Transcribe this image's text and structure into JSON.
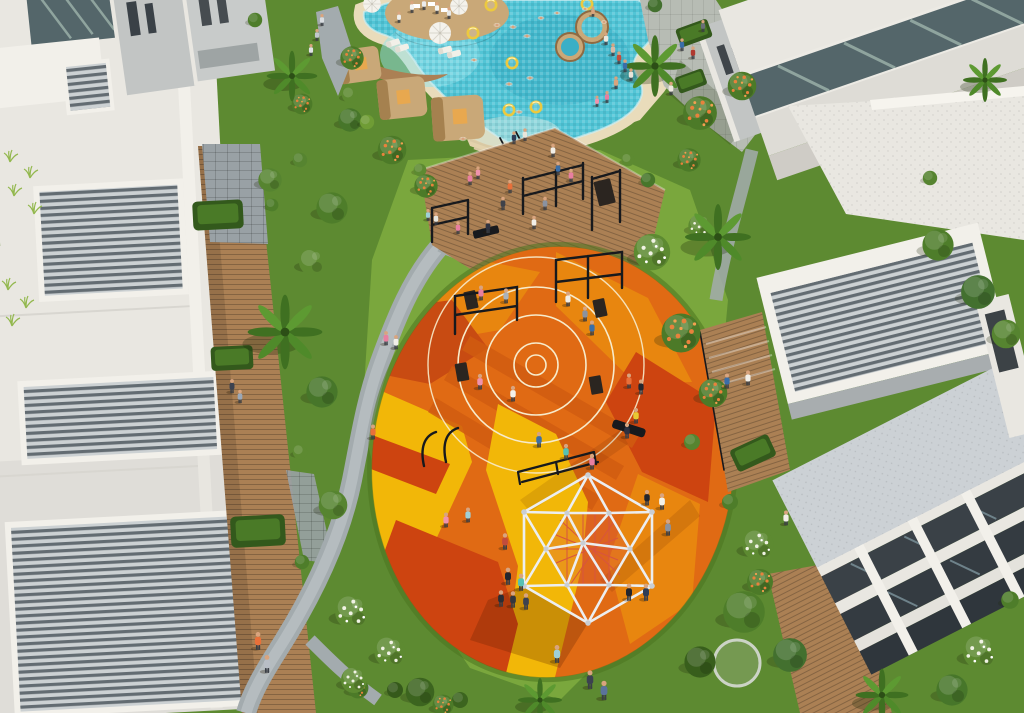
{
  "colors": {
    "poolWater": "#52c5d6",
    "poolDeep": "#3aafc6",
    "poolShallow": "#93e4ec",
    "sand": "#e9dcbb",
    "beach": "#e3d2ac",
    "woodDeck": "#ab8054",
    "woodCabana": "#c9a878",
    "cabanaDark": "#a5814f",
    "lawn": "#5d8a31",
    "lawnBright": "#7aa73d",
    "green": "#4e7d2a",
    "greenDark": "#35591b",
    "blossomOrange": "#e8823c",
    "blossomWhite": "#f0f2e4",
    "path": "#a3abae",
    "pathLight": "#c2c8ca",
    "paver": "#99a1a5",
    "promenade": "#b7bcb4",
    "white": "#f2f0ea",
    "offWhite": "#e9e7e1",
    "roofShade": "#d6d4ce",
    "grayWall": "#c2c5c4",
    "darkWall": "#3a4147",
    "louverLight": "#ccd1d3",
    "louverDark": "#636c72",
    "glass": "#54666a",
    "glassLight": "#8fa49e",
    "playOrange": "#e06a14",
    "playAmber": "#e8860f",
    "playYellow": "#f2b708",
    "playRed": "#cd4410",
    "playDeep": "#c84b12",
    "playDark": "#d05c10",
    "courtLine": "#f7ebcb",
    "equip": "#17191d",
    "board": "#2b2520",
    "domeStrut": "#eceef0",
    "domeNode": "#c9ced4",
    "domeNet": "#d8543e",
    "skin": "#d9a47e",
    "shadow": "rgba(60,30,8,0.3)"
  },
  "people": [
    {
      "x": 412,
      "y": 11,
      "c": "#f2f2ee",
      "s": 0.8
    },
    {
      "x": 424,
      "y": 8,
      "c": "#ececec",
      "s": 0.8
    },
    {
      "x": 437,
      "y": 12,
      "c": "#f4f4f0",
      "s": 0.8
    },
    {
      "x": 449,
      "y": 17,
      "c": "#e8e8e4",
      "s": 0.8
    },
    {
      "x": 399,
      "y": 21,
      "c": "#f0f0ec",
      "s": 0.75
    },
    {
      "x": 322,
      "y": 24,
      "c": "#d8dce0",
      "s": 0.8
    },
    {
      "x": 317,
      "y": 39,
      "c": "#c2c8ce",
      "s": 0.8
    },
    {
      "x": 311,
      "y": 54,
      "c": "#e0e2e6",
      "s": 0.8
    },
    {
      "x": 606,
      "y": 43,
      "c": "#ece8de",
      "s": 0.85
    },
    {
      "x": 613,
      "y": 54,
      "c": "#d9b9a6",
      "s": 0.85
    },
    {
      "x": 619,
      "y": 62,
      "c": "#c24c3c",
      "s": 0.85
    },
    {
      "x": 625,
      "y": 70,
      "c": "#3a6ea8",
      "s": 0.85
    },
    {
      "x": 631,
      "y": 79,
      "c": "#e8e4da",
      "s": 0.85
    },
    {
      "x": 616,
      "y": 87,
      "c": "#d9a47e",
      "s": 0.85
    },
    {
      "x": 607,
      "y": 101,
      "c": "#e87fa0",
      "s": 0.8
    },
    {
      "x": 597,
      "y": 105,
      "c": "#ef93ad",
      "s": 0.75
    },
    {
      "x": 682,
      "y": 49,
      "c": "#3a6ea8",
      "s": 0.85
    },
    {
      "x": 693,
      "y": 57,
      "c": "#b03a30",
      "s": 0.85
    },
    {
      "x": 671,
      "y": 93,
      "c": "#eceadf",
      "s": 0.9
    },
    {
      "x": 703,
      "y": 30,
      "c": "#6a7078",
      "s": 0.8
    },
    {
      "x": 514,
      "y": 142,
      "c": "#2e3d57",
      "s": 0.85
    },
    {
      "x": 525,
      "y": 139,
      "c": "#e8e6da",
      "s": 0.85
    },
    {
      "x": 593,
      "y": 15,
      "c": "#d9a47e",
      "s": 0.7
    },
    {
      "x": 470,
      "y": 183,
      "c": "#e87fa0",
      "s": 0.9
    },
    {
      "x": 478,
      "y": 177,
      "c": "#ef93ad",
      "s": 0.85
    },
    {
      "x": 510,
      "y": 191,
      "c": "#e8703a",
      "s": 0.9
    },
    {
      "x": 553,
      "y": 155,
      "c": "#f2efe8",
      "s": 0.9
    },
    {
      "x": 558,
      "y": 173,
      "c": "#3a6ea8",
      "s": 0.9
    },
    {
      "x": 571,
      "y": 180,
      "c": "#e87fa0",
      "s": 0.9
    },
    {
      "x": 503,
      "y": 208,
      "c": "#3e424a",
      "s": 0.9
    },
    {
      "x": 488,
      "y": 231,
      "c": "#2e3140",
      "s": 0.9
    },
    {
      "x": 436,
      "y": 223,
      "c": "#e8e6de",
      "s": 0.85
    },
    {
      "x": 428,
      "y": 219,
      "c": "#9fd0d8",
      "s": 0.8
    },
    {
      "x": 458,
      "y": 232,
      "c": "#e87fa0",
      "s": 0.85
    },
    {
      "x": 534,
      "y": 227,
      "c": "#f2efe8",
      "s": 0.9
    },
    {
      "x": 545,
      "y": 208,
      "c": "#8a92a0",
      "s": 0.9
    },
    {
      "x": 386,
      "y": 343,
      "c": "#e87fa0",
      "s": 0.95
    },
    {
      "x": 396,
      "y": 347,
      "c": "#f2efe8",
      "s": 0.95
    },
    {
      "x": 373,
      "y": 437,
      "c": "#e8703a",
      "s": 1
    },
    {
      "x": 232,
      "y": 391,
      "c": "#3c4250",
      "s": 0.95
    },
    {
      "x": 240,
      "y": 401,
      "c": "#9aa8b8",
      "s": 0.9
    },
    {
      "x": 258,
      "y": 647,
      "c": "#e8703a",
      "s": 1.2
    },
    {
      "x": 267,
      "y": 670,
      "c": "#b8bec6",
      "s": 1.2
    },
    {
      "x": 481,
      "y": 298,
      "c": "#e87fa0",
      "s": 1
    },
    {
      "x": 506,
      "y": 301,
      "c": "#aab2ba",
      "s": 1
    },
    {
      "x": 568,
      "y": 304,
      "c": "#f2efe8",
      "s": 1
    },
    {
      "x": 585,
      "y": 319,
      "c": "#8a92a0",
      "s": 1
    },
    {
      "x": 592,
      "y": 333,
      "c": "#3a6ea8",
      "s": 1
    },
    {
      "x": 480,
      "y": 387,
      "c": "#ef93ad",
      "s": 1.05
    },
    {
      "x": 513,
      "y": 399,
      "c": "#f4f2ea",
      "s": 1.05
    },
    {
      "x": 539,
      "y": 445,
      "c": "#3a6ea8",
      "s": 1.05
    },
    {
      "x": 566,
      "y": 457,
      "c": "#56c0b4",
      "s": 1.05
    },
    {
      "x": 592,
      "y": 467,
      "c": "#e87fa0",
      "s": 1.05
    },
    {
      "x": 627,
      "y": 436,
      "c": "#2e3140",
      "s": 1.05
    },
    {
      "x": 636,
      "y": 421,
      "c": "#e8c832",
      "s": 1.05
    },
    {
      "x": 629,
      "y": 386,
      "c": "#e8703a",
      "s": 1
    },
    {
      "x": 641,
      "y": 392,
      "c": "#23262e",
      "s": 1
    },
    {
      "x": 662,
      "y": 507,
      "c": "#f4f2ea",
      "s": 1.1
    },
    {
      "x": 668,
      "y": 533,
      "c": "#8a92a0",
      "s": 1.1
    },
    {
      "x": 647,
      "y": 503,
      "c": "#23262e",
      "s": 1.05
    },
    {
      "x": 446,
      "y": 525,
      "c": "#ef93ad",
      "s": 1
    },
    {
      "x": 468,
      "y": 520,
      "c": "#9fd0d8",
      "s": 1
    },
    {
      "x": 505,
      "y": 547,
      "c": "#c24c3c",
      "s": 1.1
    },
    {
      "x": 508,
      "y": 582,
      "c": "#23262e",
      "s": 1.15
    },
    {
      "x": 521,
      "y": 588,
      "c": "#56c0b4",
      "s": 1.15
    },
    {
      "x": 629,
      "y": 598,
      "c": "#23262e",
      "s": 1.15
    },
    {
      "x": 646,
      "y": 598,
      "c": "#2e3d57",
      "s": 1.15
    },
    {
      "x": 501,
      "y": 604,
      "c": "#2a2d34",
      "s": 1.1
    },
    {
      "x": 513,
      "y": 605,
      "c": "#33363e",
      "s": 1.1
    },
    {
      "x": 526,
      "y": 607,
      "c": "#3c4250",
      "s": 1.1
    },
    {
      "x": 557,
      "y": 660,
      "c": "#9fd0d8",
      "s": 1.2
    },
    {
      "x": 590,
      "y": 686,
      "c": "#3c4250",
      "s": 1.25
    },
    {
      "x": 604,
      "y": 697,
      "c": "#5b739c",
      "s": 1.3
    },
    {
      "x": 727,
      "y": 386,
      "c": "#3a6ea8",
      "s": 1
    },
    {
      "x": 748,
      "y": 383,
      "c": "#f2efe8",
      "s": 1
    },
    {
      "x": 786,
      "y": 523,
      "c": "#f2efe8",
      "s": 1
    }
  ],
  "swimmers": [
    {
      "x": 513,
      "y": 27,
      "s": 0.8
    },
    {
      "x": 497,
      "y": 25,
      "s": 0.75
    },
    {
      "x": 527,
      "y": 36,
      "s": 0.8
    },
    {
      "x": 541,
      "y": 18,
      "s": 0.75
    },
    {
      "x": 557,
      "y": 13,
      "s": 0.7
    },
    {
      "x": 585,
      "y": 9,
      "s": 0.7
    },
    {
      "x": 530,
      "y": 78,
      "s": 0.8
    },
    {
      "x": 509,
      "y": 84,
      "s": 0.8
    },
    {
      "x": 519,
      "y": 112,
      "s": 0.8
    },
    {
      "x": 463,
      "y": 139,
      "s": 0.8
    },
    {
      "x": 604,
      "y": 22,
      "s": 0.7
    },
    {
      "x": 474,
      "y": 60,
      "s": 0.75
    }
  ],
  "float_rings": [
    {
      "x": 491,
      "y": 5
    },
    {
      "x": 587,
      "y": 4
    },
    {
      "x": 473,
      "y": 33
    },
    {
      "x": 512,
      "y": 63
    },
    {
      "x": 509,
      "y": 110
    },
    {
      "x": 536,
      "y": 107
    }
  ],
  "umbrellas": [
    {
      "x": 440,
      "y": 33,
      "s": 1
    },
    {
      "x": 372,
      "y": 4,
      "s": 0.8
    },
    {
      "x": 459,
      "y": 6,
      "s": 0.8
    }
  ],
  "loungers": [
    {
      "x": 393,
      "y": 43,
      "r": -18
    },
    {
      "x": 402,
      "y": 48,
      "r": -18
    },
    {
      "x": 445,
      "y": 50,
      "r": -14
    },
    {
      "x": 454,
      "y": 54,
      "r": -14
    }
  ],
  "vegetation": {
    "palms": [
      {
        "x": 292,
        "y": 76,
        "s": 1.15
      },
      {
        "x": 655,
        "y": 66,
        "s": 1.4
      },
      {
        "x": 718,
        "y": 237,
        "s": 1.5
      },
      {
        "x": 285,
        "y": 332,
        "s": 1.7
      },
      {
        "x": 882,
        "y": 695,
        "s": 1.2
      },
      {
        "x": 540,
        "y": 700,
        "s": 1
      },
      {
        "x": 985,
        "y": 80,
        "s": 1
      }
    ],
    "trees": [
      {
        "x": 332,
        "y": 208,
        "s": 1.2,
        "c": "#4e7d2a"
      },
      {
        "x": 312,
        "y": 262,
        "s": 1,
        "c": "#5d8a31"
      },
      {
        "x": 322,
        "y": 392,
        "s": 1.2,
        "c": "#47762a"
      },
      {
        "x": 333,
        "y": 505,
        "s": 1.1,
        "c": "#568430"
      },
      {
        "x": 420,
        "y": 692,
        "s": 1.1,
        "c": "#3c641f"
      },
      {
        "x": 744,
        "y": 612,
        "s": 1.6,
        "c": "#4e7d2a"
      },
      {
        "x": 790,
        "y": 655,
        "s": 1.3,
        "c": "#43702f"
      },
      {
        "x": 700,
        "y": 662,
        "s": 1.2,
        "c": "#385e1c"
      },
      {
        "x": 938,
        "y": 245,
        "s": 1.2,
        "c": "#4e7d2a"
      },
      {
        "x": 978,
        "y": 292,
        "s": 1.3,
        "c": "#43702f"
      },
      {
        "x": 1006,
        "y": 334,
        "s": 1.1,
        "c": "#568430"
      },
      {
        "x": 952,
        "y": 690,
        "s": 1.2,
        "c": "#47762a"
      },
      {
        "x": 350,
        "y": 120,
        "s": 0.9,
        "c": "#47762a"
      },
      {
        "x": 270,
        "y": 180,
        "s": 0.9,
        "c": "#568430"
      }
    ],
    "bushes": [
      {
        "x": 350,
        "y": 95,
        "s": 1,
        "c": "#5d8a31"
      },
      {
        "x": 367,
        "y": 122,
        "s": 0.9,
        "c": "#6f9c35"
      },
      {
        "x": 300,
        "y": 160,
        "s": 0.9,
        "c": "#568430"
      },
      {
        "x": 272,
        "y": 205,
        "s": 0.8,
        "c": "#4e7d2a"
      },
      {
        "x": 300,
        "y": 452,
        "s": 0.9,
        "c": "#5d8a31"
      },
      {
        "x": 302,
        "y": 562,
        "s": 0.9,
        "c": "#4e7d2a"
      },
      {
        "x": 692,
        "y": 442,
        "s": 1,
        "c": "#568430"
      },
      {
        "x": 730,
        "y": 502,
        "s": 1,
        "c": "#4e7d2a"
      },
      {
        "x": 648,
        "y": 180,
        "s": 0.9,
        "c": "#47762a"
      },
      {
        "x": 420,
        "y": 170,
        "s": 0.8,
        "c": "#5d8a31"
      },
      {
        "x": 395,
        "y": 690,
        "s": 1,
        "c": "#35591b"
      },
      {
        "x": 460,
        "y": 700,
        "s": 1,
        "c": "#3c641f"
      },
      {
        "x": 1010,
        "y": 600,
        "s": 1.1,
        "c": "#4e7d2a"
      },
      {
        "x": 930,
        "y": 178,
        "s": 0.9,
        "c": "#568430"
      },
      {
        "x": 255,
        "y": 20,
        "s": 0.9,
        "c": "#4e7d2a"
      },
      {
        "x": 655,
        "y": 5,
        "s": 0.9,
        "c": "#43702f"
      },
      {
        "x": 628,
        "y": 160,
        "s": 0.8,
        "c": "#5d8a31"
      }
    ],
    "orange_trees": [
      {
        "x": 392,
        "y": 150,
        "s": 1.1
      },
      {
        "x": 426,
        "y": 186,
        "s": 0.9
      },
      {
        "x": 700,
        "y": 113,
        "s": 1.3
      },
      {
        "x": 742,
        "y": 86,
        "s": 1.1
      },
      {
        "x": 681,
        "y": 333,
        "s": 1.5
      },
      {
        "x": 713,
        "y": 393,
        "s": 1.1
      },
      {
        "x": 352,
        "y": 58,
        "s": 0.9
      },
      {
        "x": 302,
        "y": 104,
        "s": 0.8
      },
      {
        "x": 689,
        "y": 160,
        "s": 0.9
      },
      {
        "x": 358,
        "y": 688,
        "s": 0.8
      },
      {
        "x": 443,
        "y": 705,
        "s": 0.8
      },
      {
        "x": 760,
        "y": 582,
        "s": 1
      }
    ],
    "white_trees": [
      {
        "x": 652,
        "y": 252,
        "s": 1.4
      },
      {
        "x": 352,
        "y": 612,
        "s": 1.3
      },
      {
        "x": 390,
        "y": 652,
        "s": 1.2
      },
      {
        "x": 354,
        "y": 680,
        "s": 1
      },
      {
        "x": 758,
        "y": 545,
        "s": 1.2
      },
      {
        "x": 980,
        "y": 652,
        "s": 1.3
      },
      {
        "x": 700,
        "y": 226,
        "s": 0.9
      }
    ],
    "grass_tufts": [
      {
        "x": 10,
        "y": 162
      },
      {
        "x": 30,
        "y": 178
      },
      {
        "x": 14,
        "y": 196
      },
      {
        "x": 34,
        "y": 214
      },
      {
        "x": 8,
        "y": 290
      },
      {
        "x": 26,
        "y": 308
      },
      {
        "x": 12,
        "y": 326
      }
    ],
    "hedges": [
      {
        "x": 218,
        "y": 215,
        "s": 1.2,
        "r": -3
      },
      {
        "x": 232,
        "y": 358,
        "s": 1,
        "r": -3
      },
      {
        "x": 258,
        "y": 531,
        "s": 1.3,
        "r": -3
      },
      {
        "x": 694,
        "y": 33,
        "s": 0.8,
        "r": -20
      },
      {
        "x": 691,
        "y": 81,
        "s": 0.7,
        "r": -20
      },
      {
        "x": 753,
        "y": 453,
        "s": 1,
        "r": -25
      }
    ]
  }
}
